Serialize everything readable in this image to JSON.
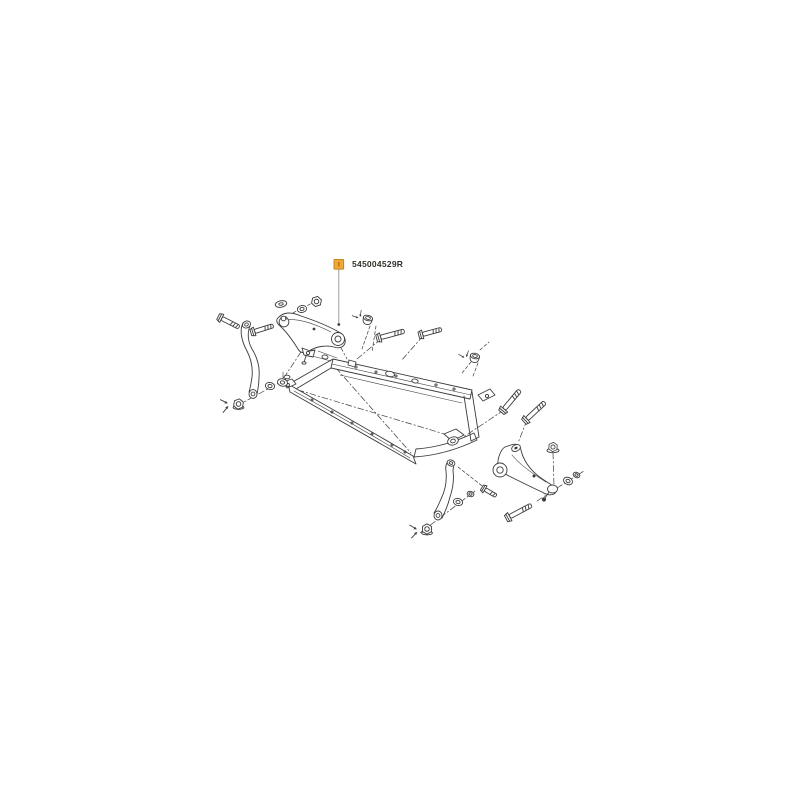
{
  "page": {
    "background": "#ffffff"
  },
  "diagram": {
    "part_number": "545004529R",
    "marker": {
      "fill": "#F0A83C",
      "border": "#C4861B",
      "inner_mark": "#BD8015"
    },
    "leader_color": "#9B9B9B",
    "line_color": "#3C3C3C",
    "text_color": "#33302B",
    "parts": [
      "front-subframe-crossmember",
      "upper-control-arm",
      "lower-control-arm",
      "stabilizer-link-upper",
      "stabilizer-link-lower",
      "mounting-bolts",
      "flange-nuts",
      "washers",
      "bushings"
    ]
  }
}
